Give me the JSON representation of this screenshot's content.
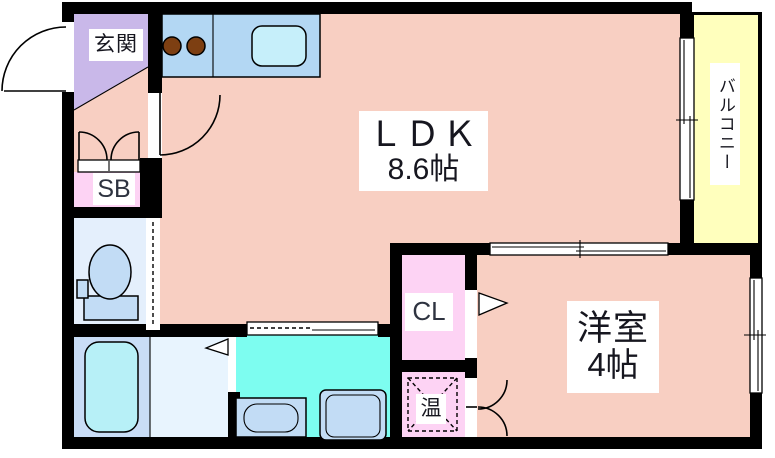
{
  "title": "1LDK apartment floor plan",
  "colors": {
    "wall": "#000000",
    "room-pink": "#f8cfc2",
    "genkan-purple": "#c9b8e9",
    "closet-pink": "#fdd3f4",
    "balcony-yellow": "#ffffbd",
    "kitchen-blue": "#b3d7f3",
    "sink-cyan": "#c6effa",
    "toilet-room-blue": "#e4effc",
    "fixture-blue": "#c2dcf5",
    "bath-room-blue": "#c9ddf6",
    "bathtub-cyan": "#b7f0f7",
    "bath-floor-blue": "#e8f4fe",
    "washroom-cyan": "#7dfdf0",
    "burner-brown": "#7d3f12"
  },
  "rooms": {
    "ldk": {
      "name": "ＬＤＫ",
      "size": "8.6帖"
    },
    "yoshitsu": {
      "name": "洋室",
      "size": "4帖"
    },
    "balcony": {
      "label": "バルコニー"
    },
    "genkan": {
      "label": "玄関"
    },
    "shoebox": {
      "label": "SB"
    },
    "closet": {
      "label": "CL"
    },
    "heater": {
      "label": "温"
    }
  }
}
